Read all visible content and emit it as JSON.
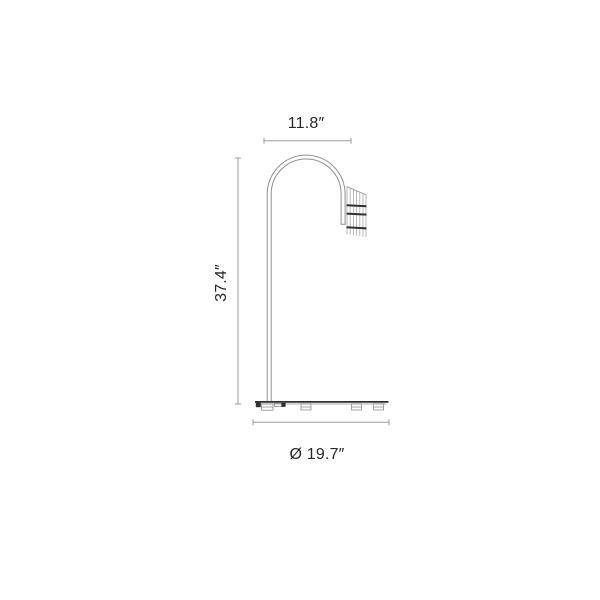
{
  "drawing": {
    "labels": {
      "top_width": "11.8″",
      "height": "37.4″",
      "base_diameter": "Ø 19.7″"
    }
  },
  "colors": {
    "background": "#ffffff",
    "text": "#282828",
    "dim_line": "#9e9e9e",
    "outline": "#909090",
    "dark_detail": "#2f2f2f"
  }
}
